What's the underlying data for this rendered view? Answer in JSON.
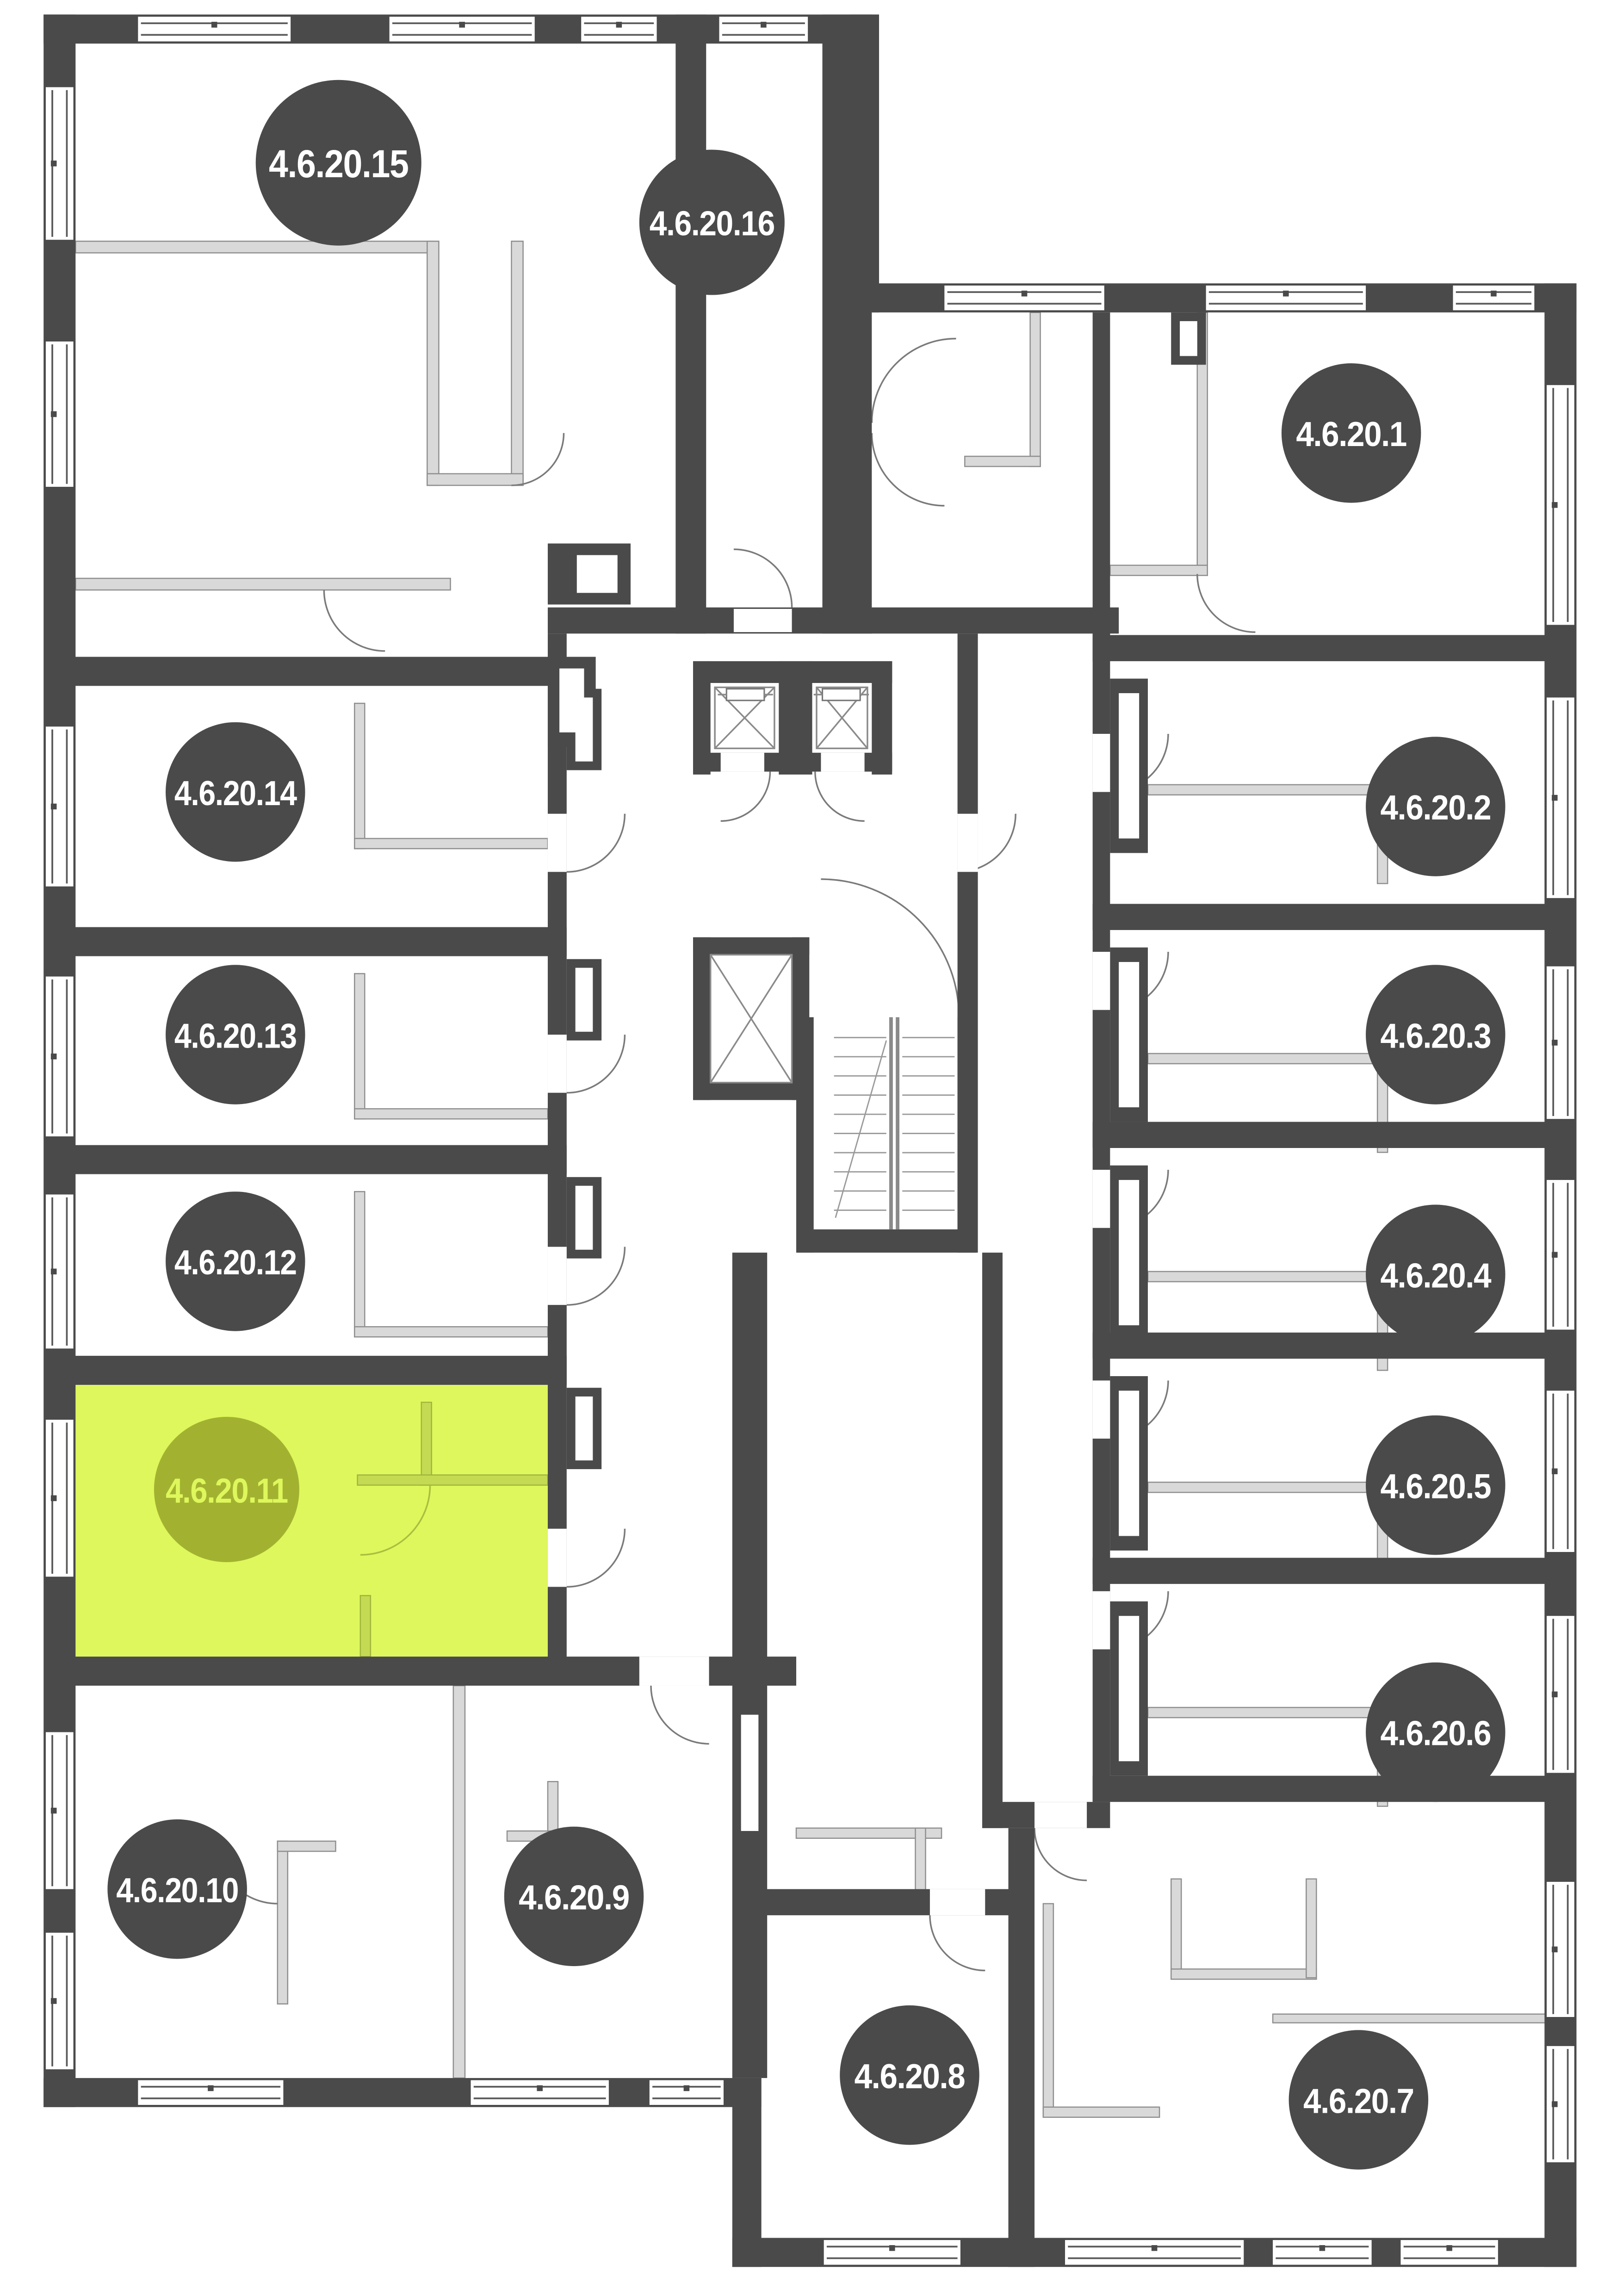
{
  "plan": {
    "colors": {
      "wall": "#4a4a4b",
      "partition": "#d9d9d9",
      "partition-stroke": "#8f8f8f",
      "door-arc": "#7a7a7a",
      "window-line": "#5a5a5a",
      "badge": "#4a4a4b",
      "badge-text": "#ffffff",
      "highlight-room": "#def75c",
      "highlight-badge": "#a2b230",
      "highlight-badge-text": "#def75c",
      "highlight-partition": "#c4da52",
      "background": "#ffffff"
    },
    "highlighted_unit": "4.6.20.11",
    "units": [
      {
        "number": 1,
        "label": "4.6.20.1",
        "highlighted": false
      },
      {
        "number": 2,
        "label": "4.6.20.2",
        "highlighted": false
      },
      {
        "number": 3,
        "label": "4.6.20.3",
        "highlighted": false
      },
      {
        "number": 4,
        "label": "4.6.20.4",
        "highlighted": false
      },
      {
        "number": 5,
        "label": "4.6.20.5",
        "highlighted": false
      },
      {
        "number": 6,
        "label": "4.6.20.6",
        "highlighted": false
      },
      {
        "number": 7,
        "label": "4.6.20.7",
        "highlighted": false
      },
      {
        "number": 8,
        "label": "4.6.20.8",
        "highlighted": false
      },
      {
        "number": 9,
        "label": "4.6.20.9",
        "highlighted": false
      },
      {
        "number": 10,
        "label": "4.6.20.10",
        "highlighted": false
      },
      {
        "number": 11,
        "label": "4.6.20.11",
        "highlighted": true
      },
      {
        "number": 12,
        "label": "4.6.20.12",
        "highlighted": false
      },
      {
        "number": 13,
        "label": "4.6.20.13",
        "highlighted": false
      },
      {
        "number": 14,
        "label": "4.6.20.14",
        "highlighted": false
      },
      {
        "number": 15,
        "label": "4.6.20.15",
        "highlighted": false
      },
      {
        "number": 16,
        "label": "4.6.20.16",
        "highlighted": false
      }
    ]
  }
}
